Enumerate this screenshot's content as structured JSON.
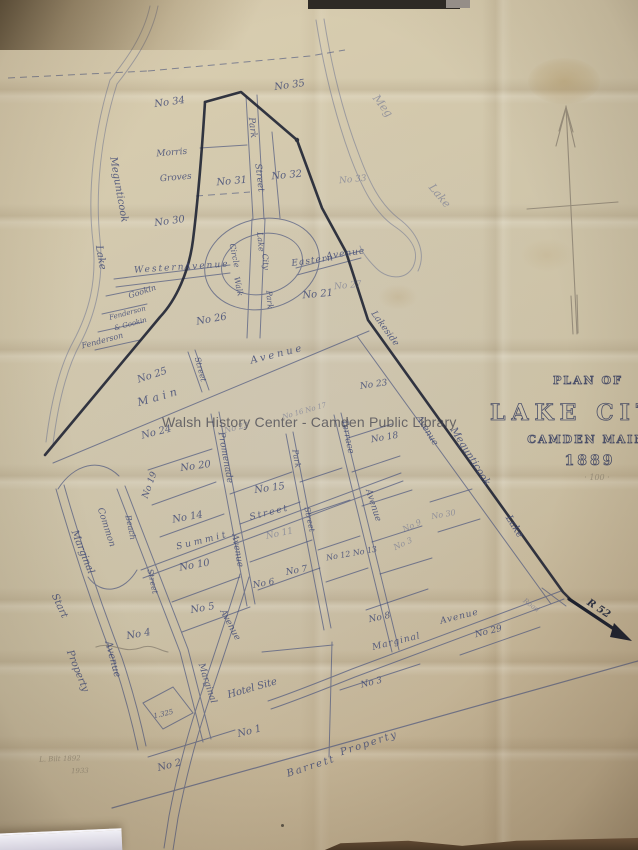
{
  "map_title": {
    "line1": "PLAN OF",
    "line2": "LAKE CITY",
    "line3": "CAMDEN MAINE",
    "line4": "1889",
    "scale_note": "100"
  },
  "watermark": {
    "text": "Walsh History Center - Camden Public Library"
  },
  "pencil_notes": {
    "line1": "L. Bilt 1892",
    "line2": "1933"
  },
  "road_sign": {
    "label": "R 52"
  },
  "paper_color": "#cfc5aa",
  "ink_color": "#3e4875",
  "heavy_line_color": "#1f2434",
  "labels": [
    {
      "t": "No 34",
      "x": 170,
      "y": 105,
      "r": -8,
      "s": 10
    },
    {
      "t": "No 35",
      "x": 290,
      "y": 88,
      "r": -8,
      "s": 10
    },
    {
      "t": "Meg",
      "x": 380,
      "y": 108,
      "r": 52,
      "s": 11,
      "c": "faint"
    },
    {
      "t": "Lake",
      "x": 437,
      "y": 198,
      "r": 50,
      "s": 11,
      "c": "faint"
    },
    {
      "t": "Morris",
      "x": 172,
      "y": 155,
      "r": -5,
      "s": 9
    },
    {
      "t": "Groves",
      "x": 176,
      "y": 180,
      "r": -5,
      "s": 9
    },
    {
      "t": "Park",
      "x": 250,
      "y": 128,
      "r": 83,
      "s": 9
    },
    {
      "t": "Street",
      "x": 257,
      "y": 178,
      "r": 83,
      "s": 9
    },
    {
      "t": "No 31",
      "x": 232,
      "y": 184,
      "r": -5,
      "s": 10
    },
    {
      "t": "No 32",
      "x": 287,
      "y": 178,
      "r": -5,
      "s": 10
    },
    {
      "t": "No 33",
      "x": 353,
      "y": 182,
      "r": -5,
      "s": 9,
      "c": "faint"
    },
    {
      "t": "No 30",
      "x": 170,
      "y": 224,
      "r": -8,
      "s": 10
    },
    {
      "t": "Megunticook",
      "x": 116,
      "y": 190,
      "r": 80,
      "s": 10
    },
    {
      "t": "Lake",
      "x": 98,
      "y": 258,
      "r": 80,
      "s": 10
    },
    {
      "t": "Western",
      "x": 160,
      "y": 271,
      "r": -4,
      "s": 9,
      "ls": 2
    },
    {
      "t": "Avenue",
      "x": 207,
      "y": 268,
      "r": -4,
      "s": 9,
      "ls": 2
    },
    {
      "t": "Eastern",
      "x": 313,
      "y": 263,
      "r": -8,
      "s": 9,
      "ls": 1
    },
    {
      "t": "Avenue",
      "x": 346,
      "y": 256,
      "r": -8,
      "s": 9,
      "ls": 1
    },
    {
      "t": "Lake",
      "x": 258,
      "y": 242,
      "r": 85,
      "s": 8
    },
    {
      "t": "City",
      "x": 263,
      "y": 262,
      "r": 85,
      "s": 8
    },
    {
      "t": "Park",
      "x": 267,
      "y": 300,
      "r": 85,
      "s": 8
    },
    {
      "t": "Circle",
      "x": 232,
      "y": 256,
      "r": 78,
      "s": 8
    },
    {
      "t": "Walk",
      "x": 236,
      "y": 287,
      "r": 78,
      "s": 8
    },
    {
      "t": "No 21",
      "x": 318,
      "y": 297,
      "r": -5,
      "s": 10
    },
    {
      "t": "No 27",
      "x": 348,
      "y": 288,
      "r": -5,
      "s": 9,
      "c": "faint"
    },
    {
      "t": "No 26",
      "x": 212,
      "y": 322,
      "r": -10,
      "s": 10
    },
    {
      "t": "Gookin",
      "x": 143,
      "y": 294,
      "r": -18,
      "s": 8
    },
    {
      "t": "Fenderson",
      "x": 128,
      "y": 315,
      "r": -15,
      "s": 7
    },
    {
      "t": "& Gookin",
      "x": 131,
      "y": 326,
      "r": -15,
      "s": 7
    },
    {
      "t": "Fenderson",
      "x": 103,
      "y": 343,
      "r": -15,
      "s": 8
    },
    {
      "t": "No 25",
      "x": 153,
      "y": 378,
      "r": -18,
      "s": 10
    },
    {
      "t": "Street",
      "x": 198,
      "y": 370,
      "r": 75,
      "s": 8
    },
    {
      "t": "Main",
      "x": 160,
      "y": 400,
      "r": -16,
      "s": 11,
      "ls": 4
    },
    {
      "t": "Avenue",
      "x": 278,
      "y": 357,
      "r": -14,
      "s": 10,
      "ls": 3
    },
    {
      "t": "Lakeside",
      "x": 383,
      "y": 330,
      "r": 54,
      "s": 9
    },
    {
      "t": "No 23",
      "x": 374,
      "y": 387,
      "r": -8,
      "s": 9
    },
    {
      "t": "No 24",
      "x": 157,
      "y": 435,
      "r": -14,
      "s": 10
    },
    {
      "t": "No 22",
      "x": 237,
      "y": 430,
      "r": -14,
      "s": 8,
      "c": "faint"
    },
    {
      "t": "No 16 No 17",
      "x": 305,
      "y": 413,
      "r": -16,
      "s": 7,
      "c": "faint"
    },
    {
      "t": "No 18",
      "x": 385,
      "y": 440,
      "r": -10,
      "s": 9
    },
    {
      "t": "Promenade",
      "x": 223,
      "y": 458,
      "r": 80,
      "s": 9
    },
    {
      "t": "Avenue",
      "x": 235,
      "y": 551,
      "r": 80,
      "s": 9
    },
    {
      "t": "No 20",
      "x": 196,
      "y": 469,
      "r": -8,
      "s": 10
    },
    {
      "t": "No 19",
      "x": 152,
      "y": 486,
      "r": -70,
      "s": 9
    },
    {
      "t": "No 15",
      "x": 270,
      "y": 491,
      "r": -8,
      "s": 10
    },
    {
      "t": "Park",
      "x": 294,
      "y": 459,
      "r": 80,
      "s": 8
    },
    {
      "t": "Street",
      "x": 307,
      "y": 520,
      "r": 78,
      "s": 8
    },
    {
      "t": "Terrace",
      "x": 345,
      "y": 437,
      "r": 78,
      "s": 9
    },
    {
      "t": "Avenue",
      "x": 371,
      "y": 506,
      "r": 72,
      "s": 9
    },
    {
      "t": "Avenue",
      "x": 425,
      "y": 432,
      "r": 58,
      "s": 9
    },
    {
      "t": "Megunticook",
      "x": 468,
      "y": 458,
      "r": 58,
      "s": 10
    },
    {
      "t": "Lake",
      "x": 512,
      "y": 528,
      "r": 58,
      "s": 10
    },
    {
      "t": "No 14",
      "x": 188,
      "y": 520,
      "r": -10,
      "s": 10
    },
    {
      "t": "Summit",
      "x": 203,
      "y": 543,
      "r": -14,
      "s": 9,
      "ls": 3
    },
    {
      "t": "Street",
      "x": 270,
      "y": 515,
      "r": -14,
      "s": 9,
      "ls": 2
    },
    {
      "t": "No 11",
      "x": 280,
      "y": 536,
      "r": -12,
      "s": 9,
      "c": "faint"
    },
    {
      "t": "No 12 No 13",
      "x": 352,
      "y": 556,
      "r": -10,
      "s": 8
    },
    {
      "t": "No 9",
      "x": 413,
      "y": 528,
      "r": -25,
      "s": 8,
      "c": "faint"
    },
    {
      "t": "No 3",
      "x": 404,
      "y": 546,
      "r": -25,
      "s": 8,
      "c": "faint"
    },
    {
      "t": "No 30",
      "x": 444,
      "y": 517,
      "r": -10,
      "s": 8,
      "c": "faint"
    },
    {
      "t": "Beach",
      "x": 128,
      "y": 528,
      "r": 78,
      "s": 8
    },
    {
      "t": "Street",
      "x": 150,
      "y": 582,
      "r": 78,
      "s": 8
    },
    {
      "t": "Common",
      "x": 104,
      "y": 528,
      "r": 72,
      "s": 9
    },
    {
      "t": "Marginal",
      "x": 80,
      "y": 553,
      "r": 68,
      "s": 10
    },
    {
      "t": "Avenue",
      "x": 110,
      "y": 660,
      "r": 75,
      "s": 10
    },
    {
      "t": "Start",
      "x": 57,
      "y": 607,
      "r": 65,
      "s": 10
    },
    {
      "t": "Property",
      "x": 75,
      "y": 672,
      "r": 68,
      "s": 10
    },
    {
      "t": "No 10",
      "x": 195,
      "y": 568,
      "r": -10,
      "s": 10
    },
    {
      "t": "No 5",
      "x": 203,
      "y": 611,
      "r": -10,
      "s": 10
    },
    {
      "t": "No 4",
      "x": 139,
      "y": 637,
      "r": -10,
      "s": 10
    },
    {
      "t": "No 6",
      "x": 264,
      "y": 586,
      "r": -10,
      "s": 9
    },
    {
      "t": "No 7",
      "x": 297,
      "y": 573,
      "r": -10,
      "s": 9
    },
    {
      "t": "No 8",
      "x": 380,
      "y": 620,
      "r": -12,
      "s": 9
    },
    {
      "t": "Avenue",
      "x": 228,
      "y": 626,
      "r": 62,
      "s": 9
    },
    {
      "t": "Marginal",
      "x": 205,
      "y": 684,
      "r": 72,
      "s": 9
    },
    {
      "t": "Marginal",
      "x": 397,
      "y": 644,
      "r": -14,
      "s": 9,
      "ls": 1
    },
    {
      "t": "Avenue",
      "x": 460,
      "y": 619,
      "r": -14,
      "s": 9,
      "ls": 1
    },
    {
      "t": "No 29",
      "x": 489,
      "y": 634,
      "r": -14,
      "s": 9
    },
    {
      "t": "No 3",
      "x": 372,
      "y": 685,
      "r": -14,
      "s": 9
    },
    {
      "t": "Hotel Site",
      "x": 253,
      "y": 691,
      "r": -16,
      "s": 10
    },
    {
      "t": "1.325",
      "x": 164,
      "y": 716,
      "r": -14,
      "s": 7
    },
    {
      "t": "No 1",
      "x": 250,
      "y": 734,
      "r": -14,
      "s": 10
    },
    {
      "t": "No 2",
      "x": 170,
      "y": 768,
      "r": -14,
      "s": 10
    },
    {
      "t": "Barrett",
      "x": 312,
      "y": 769,
      "r": -18,
      "s": 10,
      "ls": 2
    },
    {
      "t": "Property",
      "x": 370,
      "y": 746,
      "r": -18,
      "s": 10,
      "ls": 2
    },
    {
      "t": "Road",
      "x": 530,
      "y": 607,
      "r": 36,
      "s": 7,
      "c": "faint"
    },
    {
      "t": "R 52",
      "x": 597,
      "y": 611,
      "r": 33,
      "s": 10,
      "c": "heavy"
    },
    {
      "t": "PLAN OF",
      "x": 588,
      "y": 384,
      "s": 11,
      "c": "title",
      "ls": 2
    },
    {
      "t": "LAKE CITY",
      "x": 585,
      "y": 420,
      "s": 22,
      "c": "title",
      "ls": 6
    },
    {
      "t": "CAMDEN MAINE",
      "x": 592,
      "y": 443,
      "s": 11,
      "c": "title",
      "ls": 2
    },
    {
      "t": "1889",
      "x": 590,
      "y": 465,
      "s": 14,
      "c": "title",
      "ls": 3
    },
    {
      "t": "· 100 ·",
      "x": 597,
      "y": 480,
      "s": 8,
      "c": "pencil"
    },
    {
      "t": "L. Bilt 1892",
      "x": 60,
      "y": 761,
      "r": -2,
      "s": 7,
      "c": "pencil"
    },
    {
      "t": "1933",
      "x": 80,
      "y": 773,
      "r": -2,
      "s": 7,
      "c": "pencil"
    }
  ]
}
